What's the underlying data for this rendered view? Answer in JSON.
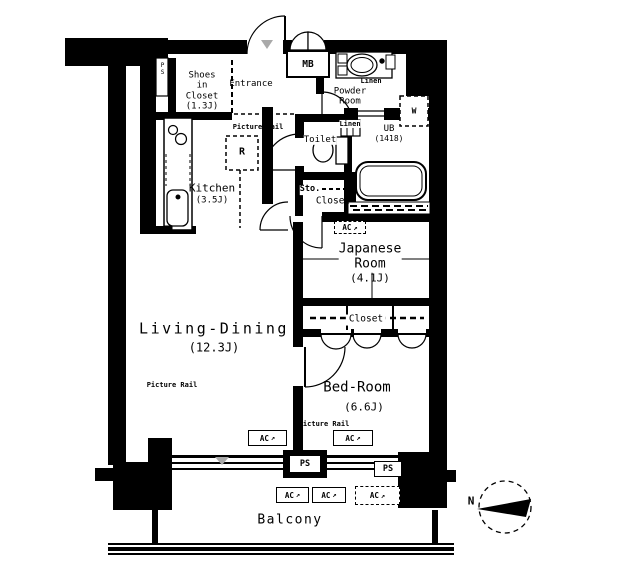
{
  "plan": {
    "rooms": {
      "living_dining": {
        "name": "Living-Dining",
        "area": "(12.3J)"
      },
      "kitchen": {
        "name": "Kitchen",
        "area": "(3.5J)"
      },
      "japanese_room": {
        "name_line1": "Japanese",
        "name_line2": "Room",
        "area": "(4.1J)"
      },
      "bedroom": {
        "name": "Bed-Room",
        "area": "(6.6J)"
      },
      "shoes_closet": {
        "line1": "Shoes",
        "line2": "in",
        "line3": "Closet",
        "area": "(1.3J)"
      },
      "entrance": {
        "name": "Entrance"
      },
      "powder_room": {
        "line1": "Powder",
        "line2": "Room"
      },
      "unit_bath": {
        "name": "UB",
        "size": "(1418)"
      },
      "toilet": {
        "name": "Toilet"
      },
      "balcony": {
        "name": "Balcony"
      }
    },
    "labels": {
      "meter_box": "MB",
      "washing_machine": "W",
      "refrigerator": "R",
      "linen": "Linen",
      "storage": "Sto.",
      "closet": "Closet",
      "pipe_shaft": "PS",
      "air_conditioner": "AC",
      "picture_rail": "Picture Rail",
      "north": "N"
    },
    "icons": {
      "ac_arrow": "↗"
    },
    "colors": {
      "line": "#000000",
      "marker_grey": "#a9a9a9",
      "background": "#ffffff"
    }
  }
}
